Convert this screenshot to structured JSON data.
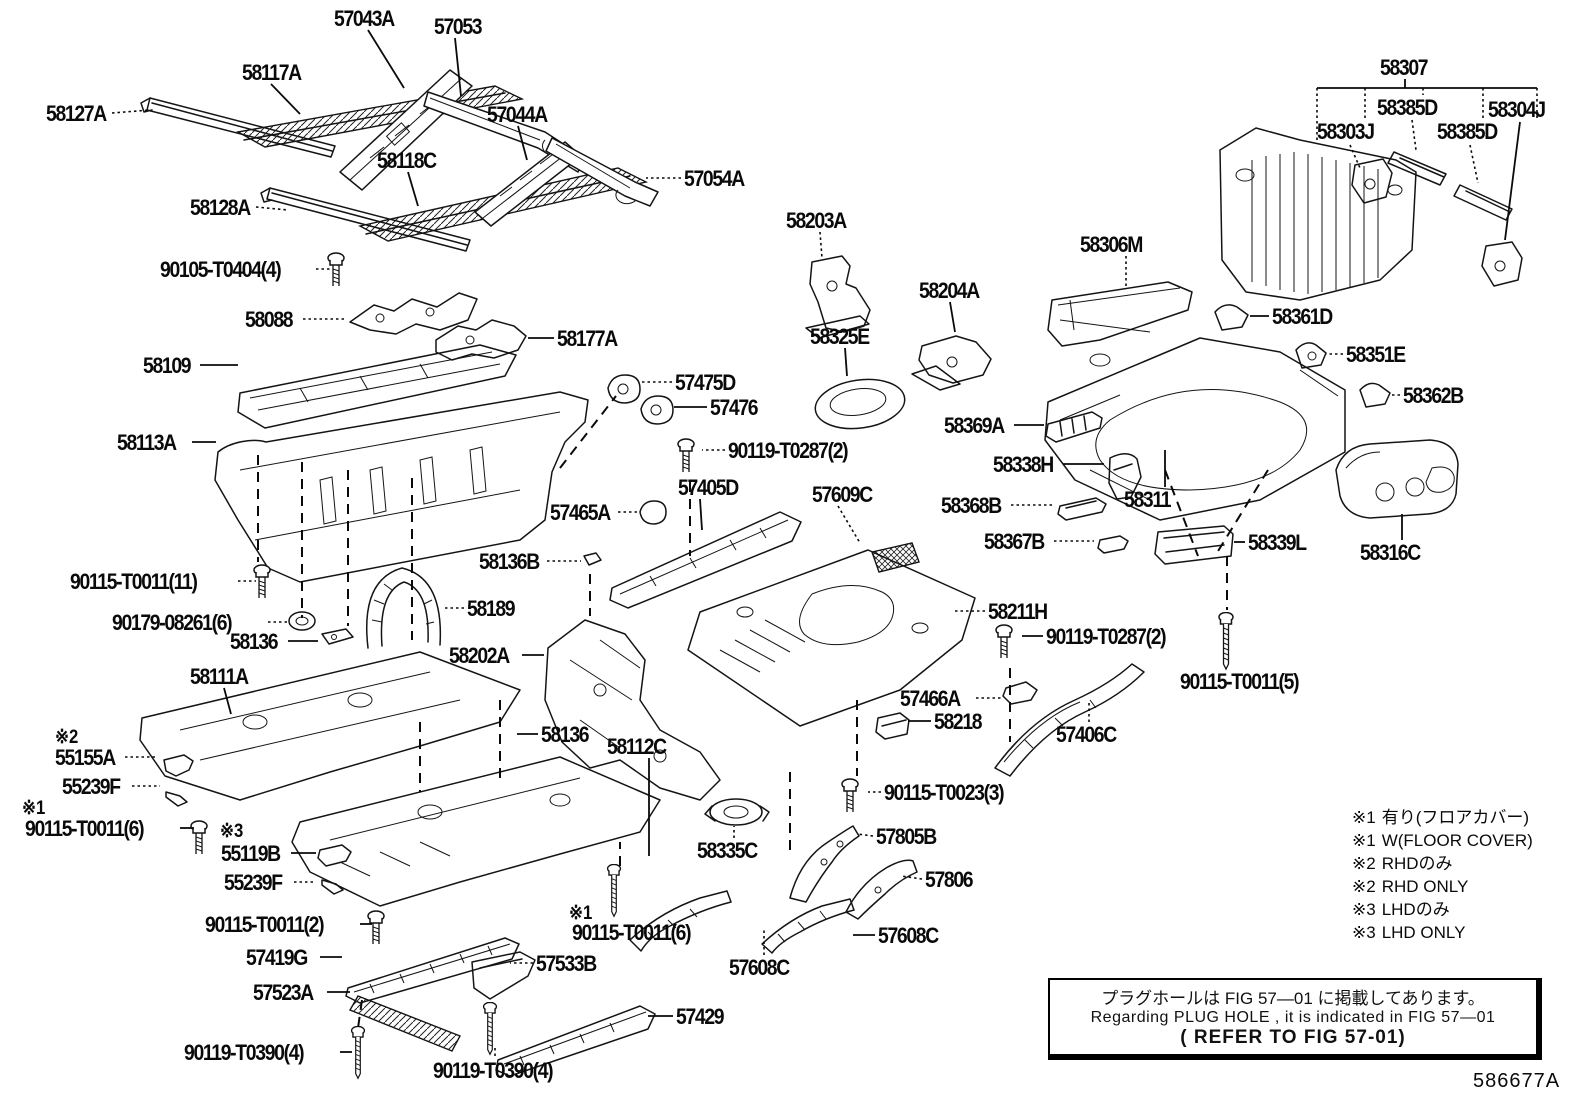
{
  "doc_number": "586677A",
  "note_box": {
    "line_jp": "プラグホールは FIG  57—01 に掲載してあります。",
    "line_en": "Regarding  PLUG  HOLE , it is indicated in FIG  57—01",
    "line_ref": "( REFER TO FIG 57-01)"
  },
  "legend": [
    {
      "mark": "※1",
      "text": "有り(フロアカバー)"
    },
    {
      "mark": "※1",
      "text": "W(FLOOR COVER)"
    },
    {
      "mark": "※2",
      "text": "RHDのみ"
    },
    {
      "mark": "※2",
      "text": "RHD ONLY"
    },
    {
      "mark": "※3",
      "text": "LHDのみ"
    },
    {
      "mark": "※3",
      "text": "LHD ONLY"
    }
  ],
  "labels": [
    {
      "t": "57043A",
      "x": 334,
      "y": 8
    },
    {
      "t": "57053",
      "x": 434,
      "y": 16
    },
    {
      "t": "58117A",
      "x": 242,
      "y": 62
    },
    {
      "t": "58127A",
      "x": 46,
      "y": 103
    },
    {
      "t": "57044A",
      "x": 487,
      "y": 104
    },
    {
      "t": "58118C",
      "x": 377,
      "y": 150
    },
    {
      "t": "57054A",
      "x": 684,
      "y": 168
    },
    {
      "t": "58128A",
      "x": 190,
      "y": 197
    },
    {
      "t": "90105-T0404(4)",
      "x": 160,
      "y": 259
    },
    {
      "t": "58088",
      "x": 245,
      "y": 309
    },
    {
      "t": "58177A",
      "x": 557,
      "y": 328
    },
    {
      "t": "58109",
      "x": 143,
      "y": 355
    },
    {
      "t": "57475D",
      "x": 675,
      "y": 372
    },
    {
      "t": "57476",
      "x": 710,
      "y": 397
    },
    {
      "t": "58113A",
      "x": 117,
      "y": 432
    },
    {
      "t": "90119-T0287(2)",
      "x": 728,
      "y": 440
    },
    {
      "t": "57405D",
      "x": 678,
      "y": 477
    },
    {
      "t": "57609C",
      "x": 812,
      "y": 484
    },
    {
      "t": "57465A",
      "x": 550,
      "y": 502
    },
    {
      "t": "58136B",
      "x": 479,
      "y": 551
    },
    {
      "t": "90115-T0011(11)",
      "x": 70,
      "y": 571
    },
    {
      "t": "58189",
      "x": 467,
      "y": 598
    },
    {
      "t": "90179-08261(6)",
      "x": 112,
      "y": 612
    },
    {
      "t": "58136",
      "x": 230,
      "y": 631
    },
    {
      "t": "58111A",
      "x": 190,
      "y": 666
    },
    {
      "t": "58202A",
      "x": 449,
      "y": 645
    },
    {
      "t": "58211H",
      "x": 988,
      "y": 601
    },
    {
      "t": "90119-T0287(2)",
      "x": 1046,
      "y": 626
    },
    {
      "t": "90115-T0011(5)",
      "x": 1180,
      "y": 671
    },
    {
      "t": "57466A",
      "x": 900,
      "y": 688
    },
    {
      "t": "58218",
      "x": 934,
      "y": 711
    },
    {
      "t": "57406C",
      "x": 1056,
      "y": 724
    },
    {
      "t": "※2",
      "x": 55,
      "y": 728
    },
    {
      "t": "55155A",
      "x": 55,
      "y": 747
    },
    {
      "t": "55239F",
      "x": 62,
      "y": 776
    },
    {
      "t": "※1",
      "x": 22,
      "y": 799
    },
    {
      "t": "90115-T0011(6)",
      "x": 25,
      "y": 818
    },
    {
      "t": "※3",
      "x": 220,
      "y": 822
    },
    {
      "t": "55119B",
      "x": 221,
      "y": 843
    },
    {
      "t": "55239F",
      "x": 224,
      "y": 872
    },
    {
      "t": "90115-T0011(2)",
      "x": 205,
      "y": 914
    },
    {
      "t": "※1",
      "x": 569,
      "y": 904
    },
    {
      "t": "90115-T0011(6)",
      "x": 572,
      "y": 922
    },
    {
      "t": "57419G",
      "x": 246,
      "y": 947
    },
    {
      "t": "57533B",
      "x": 536,
      "y": 953
    },
    {
      "t": "57523A",
      "x": 253,
      "y": 982
    },
    {
      "t": "90119-T0390(4)",
      "x": 184,
      "y": 1042
    },
    {
      "t": "57429",
      "x": 676,
      "y": 1006
    },
    {
      "t": "90119-T0390(4)",
      "x": 433,
      "y": 1060
    },
    {
      "t": "58335C",
      "x": 697,
      "y": 840
    },
    {
      "t": "57805B",
      "x": 876,
      "y": 826
    },
    {
      "t": "57806",
      "x": 925,
      "y": 869
    },
    {
      "t": "57608C",
      "x": 878,
      "y": 925
    },
    {
      "t": "57608C",
      "x": 729,
      "y": 957
    },
    {
      "t": "90115-T0023(3)",
      "x": 884,
      "y": 782
    },
    {
      "t": "58136",
      "x": 541,
      "y": 724
    },
    {
      "t": "58112C",
      "x": 607,
      "y": 736
    },
    {
      "t": "58311",
      "x": 1124,
      "y": 489
    },
    {
      "t": "58369A",
      "x": 944,
      "y": 415
    },
    {
      "t": "58338H",
      "x": 993,
      "y": 454
    },
    {
      "t": "58368B",
      "x": 941,
      "y": 495
    },
    {
      "t": "58367B",
      "x": 984,
      "y": 531
    },
    {
      "t": "58339L",
      "x": 1248,
      "y": 532
    },
    {
      "t": "58316C",
      "x": 1360,
      "y": 542
    },
    {
      "t": "58362B",
      "x": 1403,
      "y": 385
    },
    {
      "t": "58351E",
      "x": 1346,
      "y": 344
    },
    {
      "t": "58361D",
      "x": 1272,
      "y": 306
    },
    {
      "t": "58306M",
      "x": 1080,
      "y": 234
    },
    {
      "t": "58203A",
      "x": 786,
      "y": 210
    },
    {
      "t": "58204A",
      "x": 919,
      "y": 280
    },
    {
      "t": "58325E",
      "x": 810,
      "y": 326
    },
    {
      "t": "58307",
      "x": 1380,
      "y": 57
    },
    {
      "t": "58385D",
      "x": 1377,
      "y": 97
    },
    {
      "t": "58304J",
      "x": 1488,
      "y": 99
    },
    {
      "t": "58303J",
      "x": 1317,
      "y": 121
    },
    {
      "t": "58385D",
      "x": 1437,
      "y": 121
    }
  ],
  "leaders": [
    {
      "s": "s",
      "p": [
        368,
        30,
        404,
        88
      ]
    },
    {
      "s": "s",
      "p": [
        455,
        38,
        461,
        96
      ]
    },
    {
      "s": "s",
      "p": [
        271,
        84,
        300,
        114
      ]
    },
    {
      "s": "d",
      "p": [
        112,
        113,
        150,
        110
      ]
    },
    {
      "s": "s",
      "p": [
        518,
        126,
        527,
        160
      ]
    },
    {
      "s": "s",
      "p": [
        408,
        172,
        418,
        206
      ]
    },
    {
      "s": "d",
      "p": [
        681,
        178,
        646,
        178
      ]
    },
    {
      "s": "d",
      "p": [
        256,
        207,
        288,
        210
      ]
    },
    {
      "s": "d",
      "p": [
        316,
        269,
        330,
        269
      ]
    },
    {
      "s": "d",
      "p": [
        303,
        319,
        345,
        319
      ]
    },
    {
      "s": "s",
      "p": [
        554,
        338,
        528,
        338
      ]
    },
    {
      "s": "s",
      "p": [
        200,
        365,
        238,
        365
      ]
    },
    {
      "s": "d",
      "p": [
        672,
        382,
        640,
        382
      ]
    },
    {
      "s": "s",
      "p": [
        707,
        407,
        674,
        407
      ]
    },
    {
      "s": "s",
      "p": [
        192,
        442,
        216,
        442
      ]
    },
    {
      "s": "d",
      "p": [
        725,
        450,
        702,
        450
      ]
    },
    {
      "s": "s",
      "p": [
        700,
        499,
        702,
        530
      ]
    },
    {
      "s": "d",
      "p": [
        838,
        506,
        860,
        543
      ]
    },
    {
      "s": "d",
      "p": [
        618,
        512,
        638,
        512
      ]
    },
    {
      "s": "d",
      "p": [
        547,
        561,
        581,
        561
      ]
    },
    {
      "s": "d",
      "p": [
        238,
        581,
        256,
        581
      ]
    },
    {
      "s": "d",
      "p": [
        464,
        608,
        442,
        608
      ]
    },
    {
      "s": "d",
      "p": [
        268,
        622,
        288,
        622
      ]
    },
    {
      "s": "s",
      "p": [
        288,
        641,
        318,
        641
      ]
    },
    {
      "s": "s",
      "p": [
        224,
        688,
        231,
        714
      ]
    },
    {
      "s": "s",
      "p": [
        522,
        655,
        544,
        655
      ]
    },
    {
      "s": "d",
      "p": [
        985,
        611,
        954,
        611
      ]
    },
    {
      "s": "s",
      "p": [
        1043,
        636,
        1022,
        636
      ]
    },
    {
      "s": "d",
      "p": [
        976,
        698,
        1002,
        698
      ]
    },
    {
      "s": "s",
      "p": [
        931,
        721,
        908,
        721
      ]
    },
    {
      "s": "d",
      "p": [
        1089,
        722,
        1089,
        700
      ]
    },
    {
      "s": "d",
      "p": [
        125,
        757,
        158,
        757
      ]
    },
    {
      "s": "d",
      "p": [
        132,
        786,
        160,
        786
      ]
    },
    {
      "s": "s",
      "p": [
        180,
        828,
        194,
        828
      ]
    },
    {
      "s": "s",
      "p": [
        291,
        853,
        316,
        853
      ]
    },
    {
      "s": "d",
      "p": [
        294,
        882,
        316,
        882
      ]
    },
    {
      "s": "s",
      "p": [
        360,
        924,
        372,
        924
      ]
    },
    {
      "s": "s",
      "p": [
        320,
        957,
        342,
        957
      ]
    },
    {
      "s": "d",
      "p": [
        533,
        963,
        510,
        963
      ]
    },
    {
      "s": "s",
      "p": [
        327,
        992,
        350,
        992
      ]
    },
    {
      "s": "s",
      "p": [
        340,
        1052,
        352,
        1052
      ]
    },
    {
      "s": "s",
      "p": [
        673,
        1016,
        648,
        1016
      ]
    },
    {
      "s": "d",
      "p": [
        495,
        1048,
        495,
        1058
      ]
    },
    {
      "s": "d",
      "p": [
        734,
        838,
        734,
        826
      ]
    },
    {
      "s": "d",
      "p": [
        873,
        836,
        857,
        834
      ]
    },
    {
      "s": "d",
      "p": [
        922,
        879,
        901,
        876
      ]
    },
    {
      "s": "s",
      "p": [
        875,
        935,
        853,
        935
      ]
    },
    {
      "s": "d",
      "p": [
        764,
        955,
        764,
        928
      ]
    },
    {
      "s": "d",
      "p": [
        881,
        792,
        868,
        792
      ]
    },
    {
      "s": "s",
      "p": [
        538,
        734,
        517,
        734
      ]
    },
    {
      "s": "s",
      "p": [
        649,
        758,
        649,
        856
      ]
    },
    {
      "s": "s",
      "p": [
        1165,
        487,
        1165,
        450
      ]
    },
    {
      "s": "s",
      "p": [
        1014,
        425,
        1044,
        425
      ]
    },
    {
      "s": "s",
      "p": [
        1063,
        464,
        1104,
        464
      ]
    },
    {
      "s": "d",
      "p": [
        1011,
        505,
        1054,
        505
      ]
    },
    {
      "s": "d",
      "p": [
        1054,
        541,
        1094,
        541
      ]
    },
    {
      "s": "s",
      "p": [
        1245,
        542,
        1234,
        542
      ]
    },
    {
      "s": "s",
      "p": [
        1402,
        540,
        1402,
        514
      ]
    },
    {
      "s": "d",
      "p": [
        1400,
        395,
        1392,
        395
      ]
    },
    {
      "s": "d",
      "p": [
        1343,
        354,
        1326,
        354
      ]
    },
    {
      "s": "s",
      "p": [
        1269,
        316,
        1250,
        316
      ]
    },
    {
      "s": "d",
      "p": [
        1126,
        256,
        1126,
        286
      ]
    },
    {
      "s": "d",
      "p": [
        820,
        232,
        822,
        258
      ]
    },
    {
      "s": "s",
      "p": [
        950,
        302,
        955,
        332
      ]
    },
    {
      "s": "s",
      "p": [
        845,
        348,
        847,
        376
      ]
    },
    {
      "s": "s",
      "p": [
        1405,
        79,
        1405,
        88
      ]
    },
    {
      "s": "s",
      "p": [
        1317,
        88,
        1537,
        88
      ]
    },
    {
      "s": "d",
      "p": [
        1317,
        88,
        1317,
        142
      ]
    },
    {
      "s": "d",
      "p": [
        1365,
        88,
        1365,
        118
      ]
    },
    {
      "s": "d",
      "p": [
        1423,
        88,
        1423,
        95
      ]
    },
    {
      "s": "d",
      "p": [
        1483,
        88,
        1483,
        118
      ]
    },
    {
      "s": "d",
      "p": [
        1537,
        88,
        1537,
        120
      ]
    },
    {
      "s": "d",
      "p": [
        1350,
        145,
        1360,
        168
      ]
    },
    {
      "s": "d",
      "p": [
        1412,
        120,
        1416,
        150
      ]
    },
    {
      "s": "d",
      "p": [
        1470,
        145,
        1478,
        183
      ]
    },
    {
      "s": "s",
      "p": [
        1520,
        122,
        1505,
        240
      ]
    },
    {
      "s": "a",
      "p": [
        258,
        455,
        258,
        562
      ]
    },
    {
      "s": "a",
      "p": [
        302,
        462,
        302,
        618
      ]
    },
    {
      "s": "a",
      "p": [
        348,
        470,
        348,
        626
      ]
    },
    {
      "s": "a",
      "p": [
        412,
        478,
        412,
        640
      ]
    },
    {
      "s": "a",
      "p": [
        560,
        468,
        616,
        396
      ]
    },
    {
      "s": "a",
      "p": [
        590,
        574,
        590,
        616
      ]
    },
    {
      "s": "a",
      "p": [
        690,
        482,
        690,
        556
      ]
    },
    {
      "s": "a",
      "p": [
        857,
        700,
        857,
        776
      ]
    },
    {
      "s": "a",
      "p": [
        1010,
        668,
        1010,
        742
      ]
    },
    {
      "s": "a",
      "p": [
        1227,
        556,
        1227,
        610
      ]
    },
    {
      "s": "a",
      "p": [
        620,
        866,
        620,
        842
      ]
    },
    {
      "s": "a",
      "p": [
        362,
        1000,
        358,
        1028
      ]
    },
    {
      "s": "a",
      "p": [
        420,
        722,
        420,
        792
      ]
    },
    {
      "s": "a",
      "p": [
        500,
        700,
        500,
        780
      ]
    },
    {
      "s": "a",
      "p": [
        790,
        772,
        790,
        855
      ]
    },
    {
      "s": "a",
      "p": [
        1165,
        470,
        1198,
        556
      ]
    },
    {
      "s": "a",
      "p": [
        1268,
        470,
        1215,
        556
      ]
    }
  ]
}
